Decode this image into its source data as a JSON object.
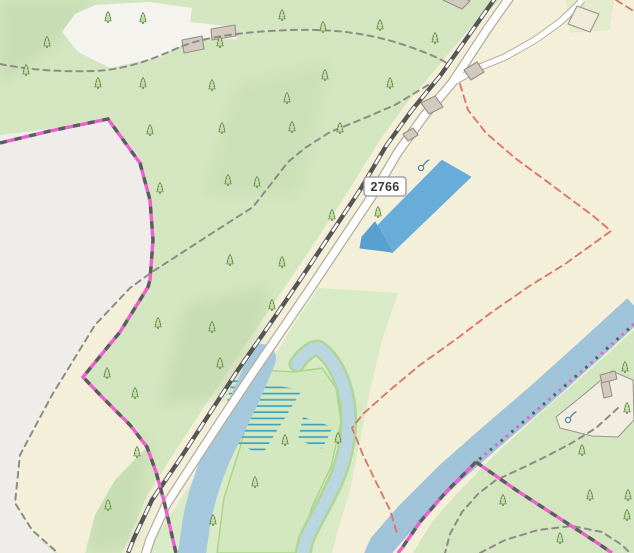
{
  "map_type": "topographic-web-map",
  "route_badge": {
    "label": "2766"
  },
  "features": [
    "coniferous-forest",
    "farmland",
    "quarry-clearing",
    "hilltop-clearing",
    "railway-line",
    "main-road",
    "side-road",
    "footpaths",
    "protected-area-boundary-pink",
    "administrative-boundary-red",
    "river",
    "canal",
    "oxbow-pond",
    "marsh-hatching",
    "blue-pond",
    "buildings",
    "farmyard"
  ],
  "icons": {
    "tree": "conifer-tree-icon",
    "spring": "spring-icon"
  },
  "trees": [
    [
      108,
      22
    ],
    [
      143,
      23
    ],
    [
      282,
      20
    ],
    [
      47,
      47
    ],
    [
      220,
      47
    ],
    [
      26,
      75
    ],
    [
      98,
      88
    ],
    [
      143,
      88
    ],
    [
      212,
      90
    ],
    [
      287,
      103
    ],
    [
      292,
      132
    ],
    [
      150,
      135
    ],
    [
      222,
      133
    ],
    [
      160,
      193
    ],
    [
      228,
      185
    ],
    [
      257,
      187
    ],
    [
      230,
      265
    ],
    [
      282,
      267
    ],
    [
      323,
      32
    ],
    [
      380,
      30
    ],
    [
      435,
      43
    ],
    [
      325,
      80
    ],
    [
      390,
      88
    ],
    [
      340,
      133
    ],
    [
      332,
      220
    ],
    [
      378,
      217
    ],
    [
      158,
      328
    ],
    [
      212,
      332
    ],
    [
      272,
      310
    ],
    [
      220,
      368
    ],
    [
      107,
      378
    ],
    [
      135,
      398
    ],
    [
      137,
      457
    ],
    [
      108,
      510
    ],
    [
      285,
      445
    ],
    [
      338,
      443
    ],
    [
      255,
      487
    ],
    [
      213,
      525
    ],
    [
      625,
      372
    ],
    [
      627,
      413
    ],
    [
      582,
      455
    ],
    [
      503,
      505
    ],
    [
      628,
      500
    ],
    [
      590,
      500
    ],
    [
      627,
      520
    ],
    [
      560,
      543
    ]
  ],
  "springs": [
    [
      421,
      168
    ],
    [
      568,
      420
    ]
  ],
  "colors": {
    "farmland": "#f3efd8",
    "forest": "#d4e6c0",
    "forestShade": "#b9d3a7",
    "clearing": "#f4f3ee",
    "quarry": "#eeedea",
    "floodplain": "#d8eac6",
    "islandFill": "#d4e8bf",
    "islandEdge": "#a9d786",
    "garden": "#e2ebcb",
    "water": "#a6c8dc",
    "canal": "#9fc3d8",
    "oxbow": "#bad6e0",
    "oxbowEdge": "#b0d595",
    "pond": "#68acd9",
    "pondDark": "#58a0cf",
    "marshLine": "#3ba4c3",
    "railway": "#555555",
    "railwayDash": "#ffffff",
    "roadCasing": "#b3ada4",
    "roadFill": "#fdfdfc",
    "pathDash": "#8d8d85",
    "boundaryPink": "#ee5ecd",
    "boundaryDark": "#575f5c",
    "boundaryRed": "#dd7266",
    "building": "#d2c9c0",
    "buildingEdge": "#998f83",
    "buildingCream": "#f0ead9",
    "farmyard": "#f1eee1",
    "farmyardEdge": "#9b9589",
    "treeFill": "#c6dda6",
    "treeEdge": "#558040",
    "badgeBg": "#fdfdfd",
    "badgeBorder": "#979797",
    "badgeText": "#3a3a3a",
    "springIcon": "#5b7f9e"
  }
}
